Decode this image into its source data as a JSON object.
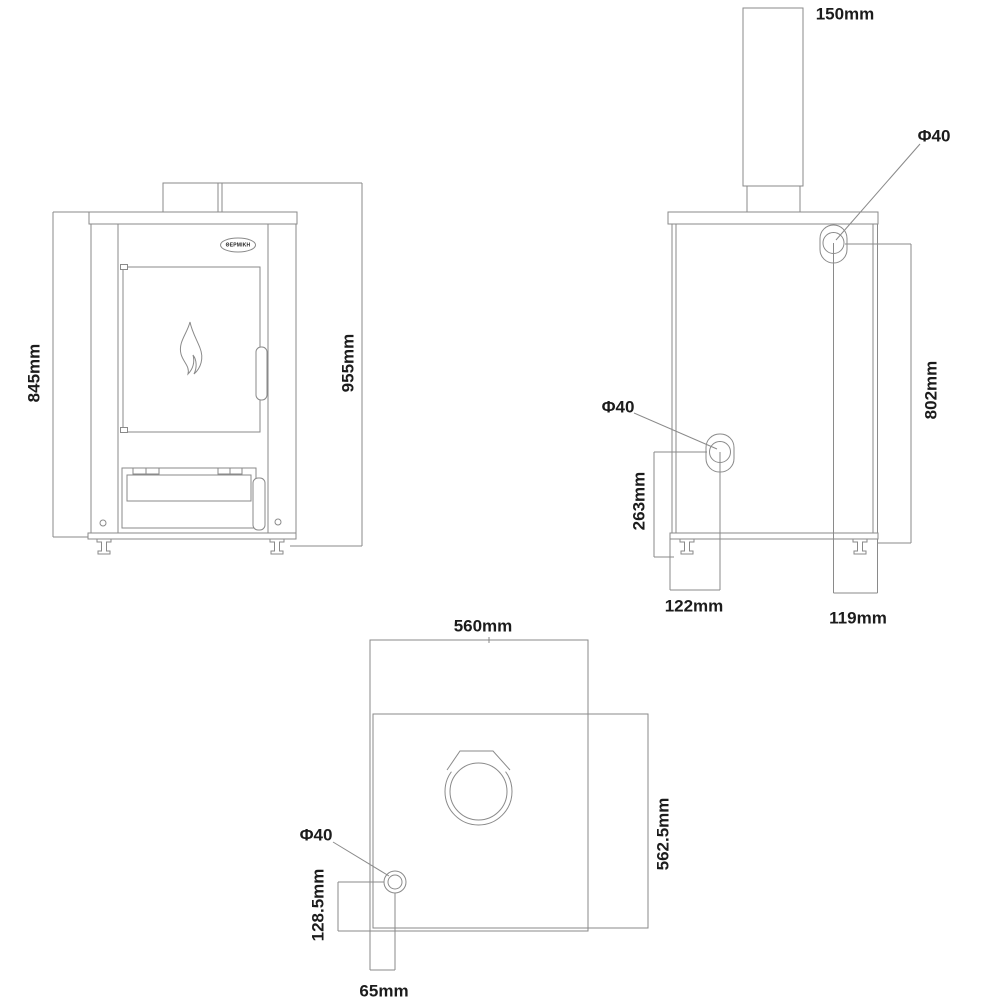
{
  "colors": {
    "background": "#ffffff",
    "line": "#8a8a8a",
    "label": "#1c1c1c"
  },
  "brand": {
    "badge_text": "ΘΕΡΜΙΚΗ"
  },
  "front_view": {
    "body_height": "845mm",
    "total_height": "955mm"
  },
  "back_view": {
    "flue_pipe_width": "150mm",
    "upper_fitting_diameter": "Φ40",
    "lower_fitting_diameter": "Φ40",
    "upper_fitting_height": "802mm",
    "lower_fitting_height": "263mm",
    "lower_fitting_offset": "122mm",
    "upper_fitting_offset": "119mm"
  },
  "top_view": {
    "width": "560mm",
    "depth": "562.5mm",
    "fitting_diameter": "Φ40",
    "fitting_offset_depth": "128.5mm",
    "fitting_offset_width": "65mm"
  }
}
